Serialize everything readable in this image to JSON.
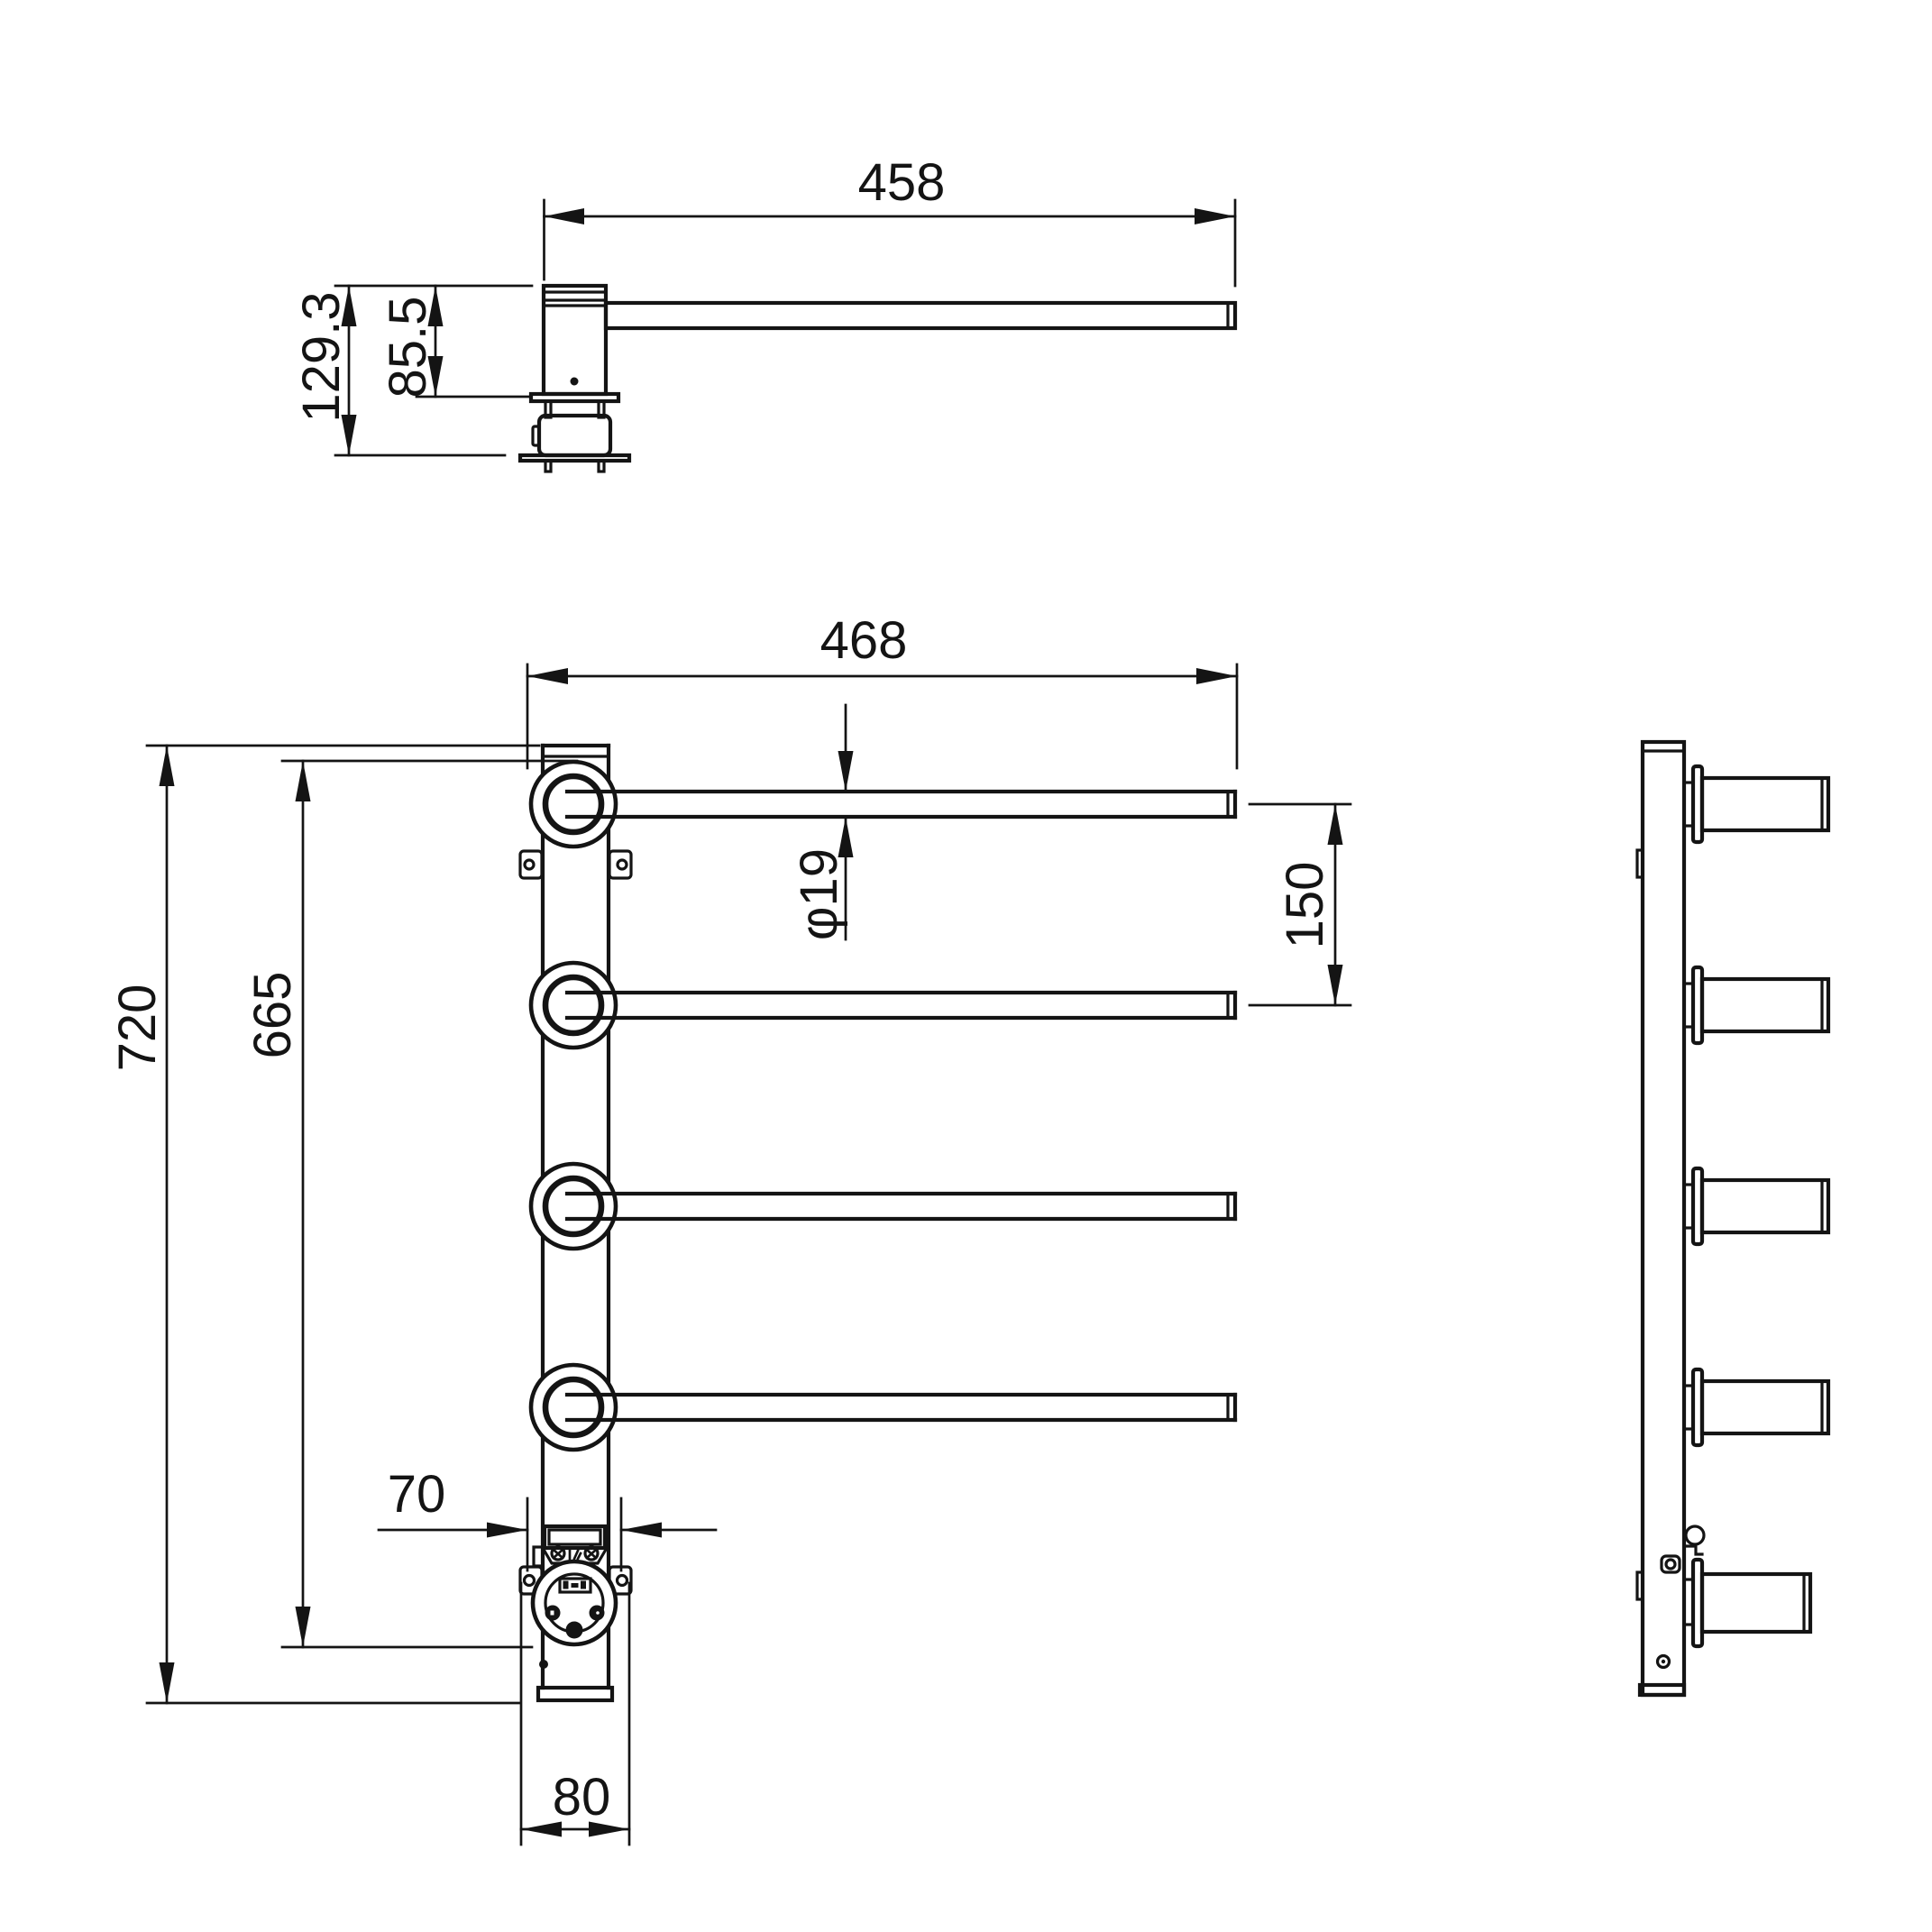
{
  "page": {
    "background": "#ffffff",
    "description": "Technical dimension drawing of a wall-mounted electric towel rack with four swing bars: top view, front view and side view"
  },
  "drawing": {
    "stroke_color": "#141414",
    "views": {
      "top_view": {
        "dims": {
          "bar_length": "458",
          "total_depth": "129.3",
          "upper_depth": "85.5"
        }
      },
      "front_view": {
        "dims": {
          "total_width": "468",
          "bar_diameter": "φ19",
          "bar_spacing": "150",
          "total_height": "720",
          "socket_center_height": "665",
          "screw_spacing": "70",
          "base_width": "80"
        }
      },
      "side_view": {
        "dims": {}
      }
    }
  }
}
